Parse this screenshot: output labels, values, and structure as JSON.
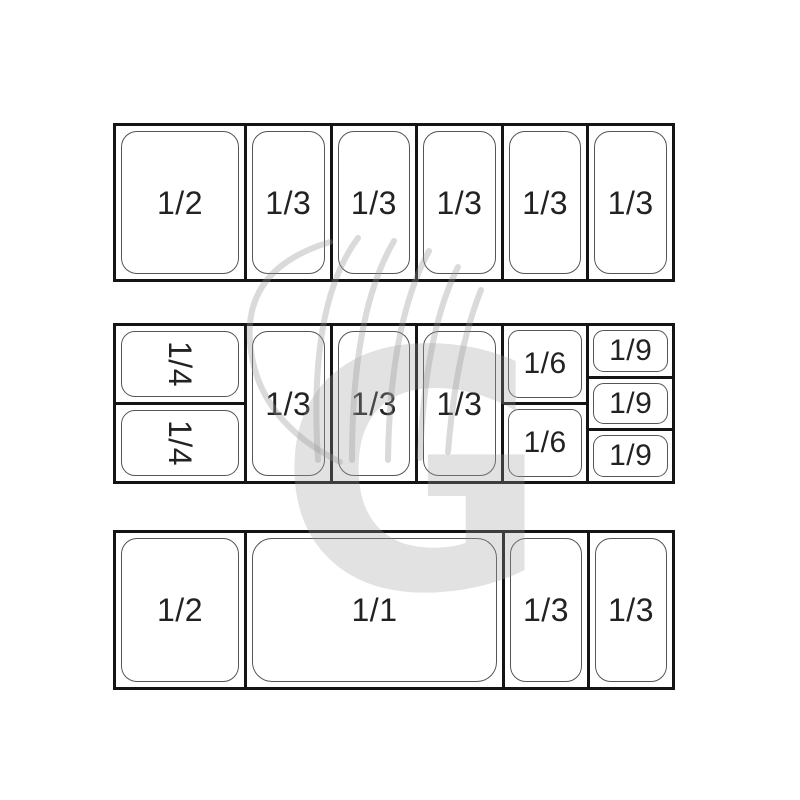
{
  "diagram_title": "gastronorm-pan-configurations",
  "row1": {
    "cells": [
      "1/2",
      "1/3",
      "1/3",
      "1/3",
      "1/3",
      "1/3"
    ]
  },
  "row2": {
    "quarter_cells": [
      "1/4",
      "1/4"
    ],
    "third_cells": [
      "1/3",
      "1/3",
      "1/3"
    ],
    "sixth_cells": [
      "1/6",
      "1/6"
    ],
    "ninth_cells": [
      "1/9",
      "1/9",
      "1/9"
    ]
  },
  "row3": {
    "cells": [
      "1/2",
      "1/1",
      "1/3",
      "1/3"
    ]
  },
  "watermark": {
    "letter": "G",
    "icon": "chef-hat-icon",
    "color": "#9e9e9e"
  },
  "colors": {
    "background": "#ffffff",
    "tray_border": "#141414",
    "pan_outline": "#555555",
    "label": "#222222"
  }
}
